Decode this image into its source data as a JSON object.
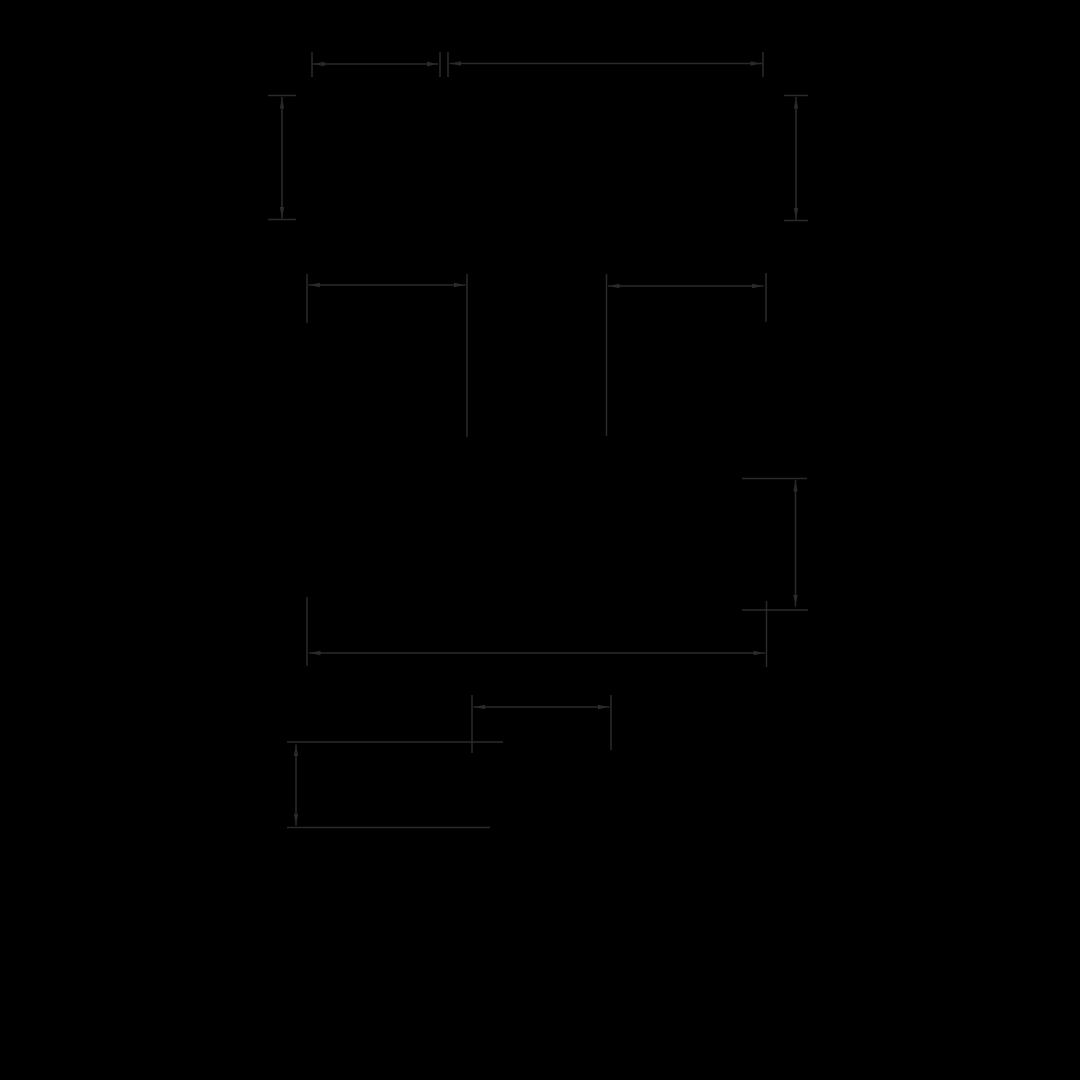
{
  "canvas": {
    "width": 1080,
    "height": 1080,
    "background": "#000000"
  },
  "drawing": {
    "stroke_color": "#2a2a2a",
    "stroke_width": 1.5,
    "arrow_length": 11,
    "arrow_half_width": 2.2,
    "groups": [
      {
        "name": "top-width-dimension-left",
        "segments": [
          {
            "role": "extension-tick",
            "x1": 312,
            "y1": 52,
            "x2": 312,
            "y2": 77
          },
          {
            "role": "dimension-line",
            "x1": 313,
            "y1": 64,
            "x2": 438,
            "y2": 64
          },
          {
            "role": "extension-tick",
            "x1": 440,
            "y1": 52,
            "x2": 440,
            "y2": 77
          }
        ],
        "arrows": [
          {
            "x": 313.5,
            "y": 64,
            "dir": "left"
          },
          {
            "x": 438,
            "y": 64,
            "dir": "right"
          }
        ]
      },
      {
        "name": "top-width-dimension-right",
        "segments": [
          {
            "role": "extension-tick",
            "x1": 448,
            "y1": 52,
            "x2": 448,
            "y2": 77
          },
          {
            "role": "dimension-line",
            "x1": 449.5,
            "y1": 63.5,
            "x2": 762,
            "y2": 63.5
          },
          {
            "role": "extension-tick",
            "x1": 763,
            "y1": 52,
            "x2": 763,
            "y2": 77
          }
        ],
        "arrows": [
          {
            "x": 450,
            "y": 63.5,
            "dir": "left"
          },
          {
            "x": 761.5,
            "y": 63.5,
            "dir": "right"
          }
        ]
      },
      {
        "name": "upper-left-height-dimension",
        "segments": [
          {
            "role": "extension-tick",
            "x1": 268,
            "y1": 95.5,
            "x2": 296,
            "y2": 95.5
          },
          {
            "role": "dimension-line",
            "x1": 282,
            "y1": 97,
            "x2": 282,
            "y2": 218.5
          },
          {
            "role": "extension-tick",
            "x1": 268,
            "y1": 219.5,
            "x2": 296,
            "y2": 219.5
          }
        ],
        "arrows": [
          {
            "x": 282,
            "y": 97.5,
            "dir": "up"
          },
          {
            "x": 282,
            "y": 218,
            "dir": "down"
          }
        ]
      },
      {
        "name": "upper-right-height-dimension",
        "segments": [
          {
            "role": "extension-tick",
            "x1": 784,
            "y1": 95.5,
            "x2": 808,
            "y2": 95.5
          },
          {
            "role": "dimension-line",
            "x1": 796,
            "y1": 97,
            "x2": 796,
            "y2": 219.5
          },
          {
            "role": "extension-tick",
            "x1": 784,
            "y1": 220.5,
            "x2": 808,
            "y2": 220.5
          }
        ],
        "arrows": [
          {
            "x": 796,
            "y": 97.5,
            "dir": "up"
          },
          {
            "x": 796,
            "y": 219,
            "dir": "down"
          }
        ]
      },
      {
        "name": "middle-left-width-dimension",
        "segments": [
          {
            "role": "extension-line",
            "x1": 307,
            "y1": 274,
            "x2": 307,
            "y2": 323
          },
          {
            "role": "dimension-line",
            "x1": 308.5,
            "y1": 285,
            "x2": 465.5,
            "y2": 285
          },
          {
            "role": "extension-line",
            "x1": 467,
            "y1": 274,
            "x2": 467,
            "y2": 437
          }
        ],
        "arrows": [
          {
            "x": 309,
            "y": 285,
            "dir": "left"
          },
          {
            "x": 465,
            "y": 285,
            "dir": "right"
          }
        ]
      },
      {
        "name": "middle-right-width-dimension",
        "segments": [
          {
            "role": "extension-line",
            "x1": 606.5,
            "y1": 274,
            "x2": 606.5,
            "y2": 436
          },
          {
            "role": "dimension-line",
            "x1": 608,
            "y1": 286,
            "x2": 763.5,
            "y2": 286
          },
          {
            "role": "extension-line",
            "x1": 766,
            "y1": 273,
            "x2": 766,
            "y2": 322
          }
        ],
        "arrows": [
          {
            "x": 608.5,
            "y": 286,
            "dir": "left"
          },
          {
            "x": 763,
            "y": 286,
            "dir": "right"
          }
        ]
      },
      {
        "name": "lower-right-height-dimension",
        "segments": [
          {
            "role": "extension-tick",
            "x1": 742,
            "y1": 478.5,
            "x2": 807,
            "y2": 478.5
          },
          {
            "role": "dimension-line",
            "x1": 795.5,
            "y1": 480,
            "x2": 795.5,
            "y2": 606.5
          },
          {
            "role": "extension-tick",
            "x1": 742,
            "y1": 610,
            "x2": 808,
            "y2": 610
          }
        ],
        "arrows": [
          {
            "x": 795.5,
            "y": 480.5,
            "dir": "up"
          },
          {
            "x": 795.5,
            "y": 606,
            "dir": "down"
          }
        ]
      },
      {
        "name": "overall-width-dimension",
        "segments": [
          {
            "role": "extension-line",
            "x1": 307,
            "y1": 597,
            "x2": 307,
            "y2": 666
          },
          {
            "role": "dimension-line",
            "x1": 309,
            "y1": 653,
            "x2": 765,
            "y2": 653
          },
          {
            "role": "extension-line",
            "x1": 766.5,
            "y1": 601,
            "x2": 766.5,
            "y2": 667
          }
        ],
        "arrows": [
          {
            "x": 309.5,
            "y": 653,
            "dir": "left"
          },
          {
            "x": 764.5,
            "y": 653,
            "dir": "right"
          }
        ]
      },
      {
        "name": "small-width-dimension",
        "segments": [
          {
            "role": "extension-line",
            "x1": 472,
            "y1": 695,
            "x2": 472,
            "y2": 753
          },
          {
            "role": "dimension-line",
            "x1": 473.5,
            "y1": 707,
            "x2": 609.5,
            "y2": 707
          },
          {
            "role": "extension-line",
            "x1": 611,
            "y1": 695,
            "x2": 611,
            "y2": 750
          }
        ],
        "arrows": [
          {
            "x": 474,
            "y": 707,
            "dir": "left"
          },
          {
            "x": 609,
            "y": 707,
            "dir": "right"
          }
        ]
      },
      {
        "name": "bottom-left-height-dimension",
        "segments": [
          {
            "role": "extension-line",
            "x1": 287,
            "y1": 742,
            "x2": 503,
            "y2": 742
          },
          {
            "role": "dimension-line",
            "x1": 296,
            "y1": 744.5,
            "x2": 296,
            "y2": 825.5
          },
          {
            "role": "extension-line",
            "x1": 287,
            "y1": 827.5,
            "x2": 490,
            "y2": 827.5
          }
        ],
        "arrows": [
          {
            "x": 296,
            "y": 745,
            "dir": "up"
          },
          {
            "x": 296,
            "y": 825,
            "dir": "down"
          }
        ]
      }
    ]
  }
}
